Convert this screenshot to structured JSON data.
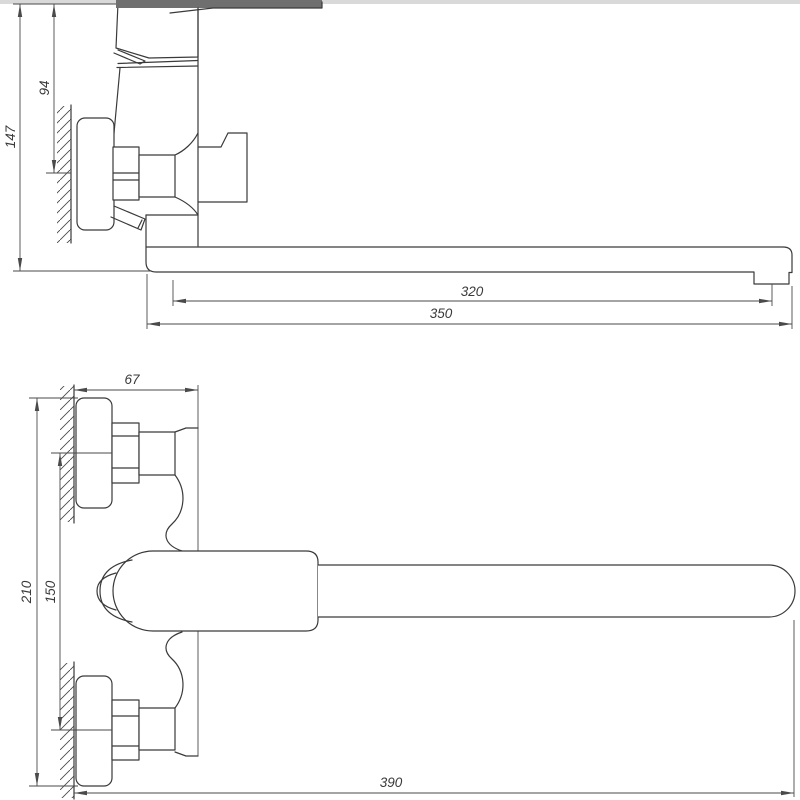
{
  "side_view": {
    "dim_total_height": "147",
    "dim_top_to_inlet_axis": "94",
    "dim_spout_to_aerator": "320",
    "dim_spout_total_length": "350"
  },
  "plan_view": {
    "dim_wall_to_body_front": "67",
    "dim_escutcheon_outer_span": "210",
    "dim_inlet_center_distance": "150",
    "dim_total_length_to_spout_tip": "390"
  },
  "colors": {
    "line": "#3a3a3a",
    "dimension_line": "#4a4a4a",
    "handle_cut_fill": "#6f6f6f",
    "top_strip": "#d9d9d9",
    "background": "#ffffff"
  }
}
